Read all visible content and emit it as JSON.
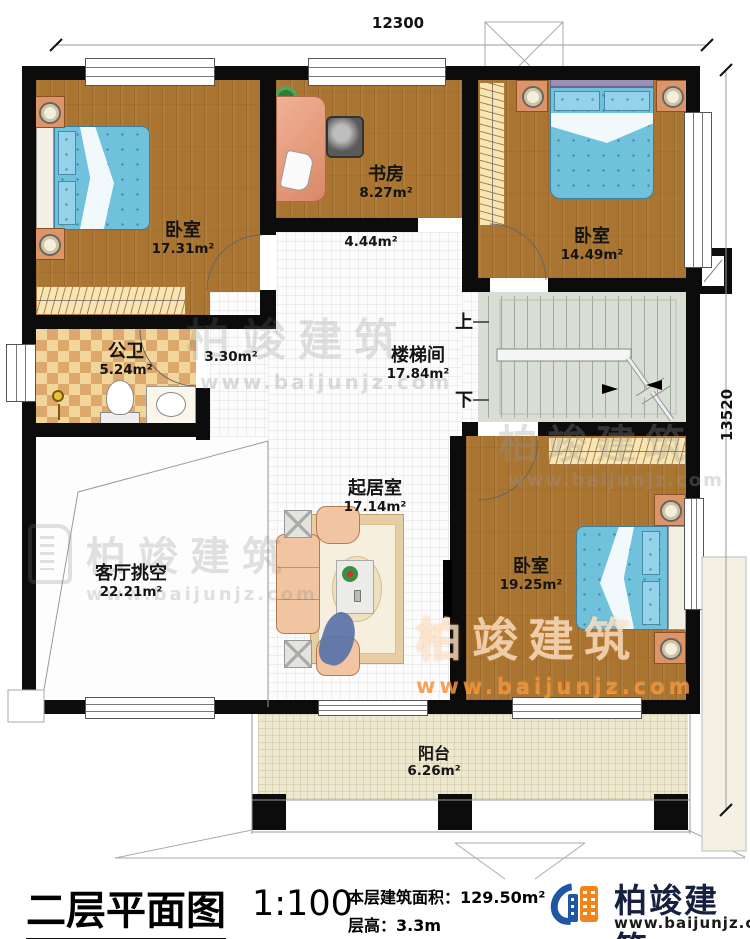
{
  "dimensions": {
    "top_width": "12300",
    "right_height": "13520"
  },
  "rooms": {
    "bedroom_top_left": {
      "name": "卧室",
      "area": "17.31m²"
    },
    "study": {
      "name": "书房",
      "area": "8.27m²"
    },
    "hall": {
      "area": "4.44m²"
    },
    "bedroom_top_right": {
      "name": "卧室",
      "area": "14.49m²"
    },
    "bathroom": {
      "name": "公卫",
      "area": "5.24m²"
    },
    "corridor": {
      "area": "3.30m²"
    },
    "stairwell": {
      "name": "楼梯间",
      "area": "17.84m²"
    },
    "living_void": {
      "name": "客厅挑空",
      "area": "22.21m²"
    },
    "sitting_room": {
      "name": "起居室",
      "area": "17.14m²"
    },
    "bedroom_bottom_right": {
      "name": "卧室",
      "area": "19.25m²"
    },
    "balcony": {
      "name": "阳台",
      "area": "6.26m²"
    }
  },
  "stairs": {
    "up_label": "上",
    "down_label": "下"
  },
  "watermark": {
    "text": "柏竣建筑",
    "url": "www.baijunjz.com"
  },
  "title_block": {
    "drawing_title": "二层平面图",
    "scale": "1:100",
    "area_text": "本层建筑面积：129.50m²",
    "height_text": "层高：3.3m"
  },
  "brand": {
    "name": "柏竣建筑",
    "website": "www.baijunjz.com"
  },
  "colors": {
    "wall": "#0c0c0c",
    "wood_floor": "#aa7531",
    "bed_fabric": "#6fc1dc",
    "bath_tile": "#e9c585",
    "stair_floor": "#d9ded4",
    "balcony_floor": "#eee8cf",
    "brand_blue": "#1d57a5",
    "brand_orange": "#f08519"
  }
}
